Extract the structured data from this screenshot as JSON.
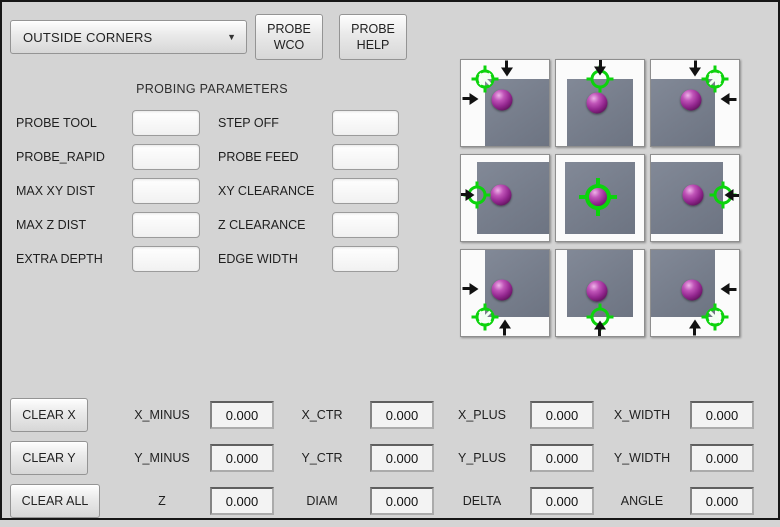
{
  "header": {
    "mode_dropdown": {
      "value": "OUTSIDE CORNERS"
    },
    "probe_wco_button": {
      "line1": "PROBE",
      "line2": "WCO"
    },
    "probe_help_button": {
      "line1": "PROBE",
      "line2": "HELP"
    }
  },
  "parameters": {
    "title": "PROBING PARAMETERS",
    "left": [
      {
        "label": "PROBE TOOL",
        "value": ""
      },
      {
        "label": "PROBE_RAPID",
        "value": ""
      },
      {
        "label": "MAX XY DIST",
        "value": ""
      },
      {
        "label": "MAX Z DIST",
        "value": ""
      },
      {
        "label": "EXTRA DEPTH",
        "value": ""
      }
    ],
    "right": [
      {
        "label": "STEP OFF",
        "value": ""
      },
      {
        "label": "PROBE FEED",
        "value": ""
      },
      {
        "label": "XY CLEARANCE",
        "value": ""
      },
      {
        "label": "Z CLEARANCE",
        "value": ""
      },
      {
        "label": "EDGE WIDTH",
        "value": ""
      }
    ]
  },
  "probe_grid": {
    "colors": {
      "target_green": "#0cd30c",
      "workpiece_gray": "#767d8b",
      "sphere_purple": "#93278f",
      "arrow_black": "#121212"
    },
    "cells": [
      {
        "name": "probe-corner-top-left",
        "icons": [
          "target-corner-icon",
          "arrow-down-icon",
          "arrow-right-icon",
          "probe-sphere-icon"
        ]
      },
      {
        "name": "probe-edge-top",
        "icons": [
          "target-edge-icon",
          "arrow-down-icon",
          "probe-sphere-icon"
        ]
      },
      {
        "name": "probe-corner-top-right",
        "icons": [
          "target-corner-icon",
          "arrow-down-icon",
          "arrow-left-icon",
          "probe-sphere-icon"
        ]
      },
      {
        "name": "probe-edge-left",
        "icons": [
          "target-edge-icon",
          "arrow-right-icon",
          "probe-sphere-icon"
        ]
      },
      {
        "name": "probe-center",
        "icons": [
          "target-center-icon",
          "probe-sphere-icon"
        ]
      },
      {
        "name": "probe-edge-right",
        "icons": [
          "target-edge-icon",
          "arrow-left-icon",
          "probe-sphere-icon"
        ]
      },
      {
        "name": "probe-corner-bottom-left",
        "icons": [
          "target-corner-icon",
          "arrow-up-icon",
          "arrow-right-icon",
          "probe-sphere-icon"
        ]
      },
      {
        "name": "probe-edge-bottom",
        "icons": [
          "target-edge-icon",
          "arrow-up-icon",
          "probe-sphere-icon"
        ]
      },
      {
        "name": "probe-corner-bottom-right",
        "icons": [
          "target-corner-icon",
          "arrow-up-icon",
          "arrow-left-icon",
          "probe-sphere-icon"
        ]
      }
    ]
  },
  "results": {
    "clear_buttons": [
      {
        "label": "CLEAR X"
      },
      {
        "label": "CLEAR Y"
      },
      {
        "label": "CLEAR ALL"
      }
    ],
    "rows": [
      {
        "entries": [
          {
            "label": "X_MINUS",
            "value": "0.000"
          },
          {
            "label": "X_CTR",
            "value": "0.000"
          },
          {
            "label": "X_PLUS",
            "value": "0.000"
          },
          {
            "label": "X_WIDTH",
            "value": "0.000"
          }
        ]
      },
      {
        "entries": [
          {
            "label": "Y_MINUS",
            "value": "0.000"
          },
          {
            "label": "Y_CTR",
            "value": "0.000"
          },
          {
            "label": "Y_PLUS",
            "value": "0.000"
          },
          {
            "label": "Y_WIDTH",
            "value": "0.000"
          }
        ]
      },
      {
        "entries": [
          {
            "label": "Z",
            "value": "0.000"
          },
          {
            "label": "DIAM",
            "value": "0.000"
          },
          {
            "label": "DELTA",
            "value": "0.000"
          },
          {
            "label": "ANGLE",
            "value": "0.000"
          }
        ]
      }
    ]
  }
}
